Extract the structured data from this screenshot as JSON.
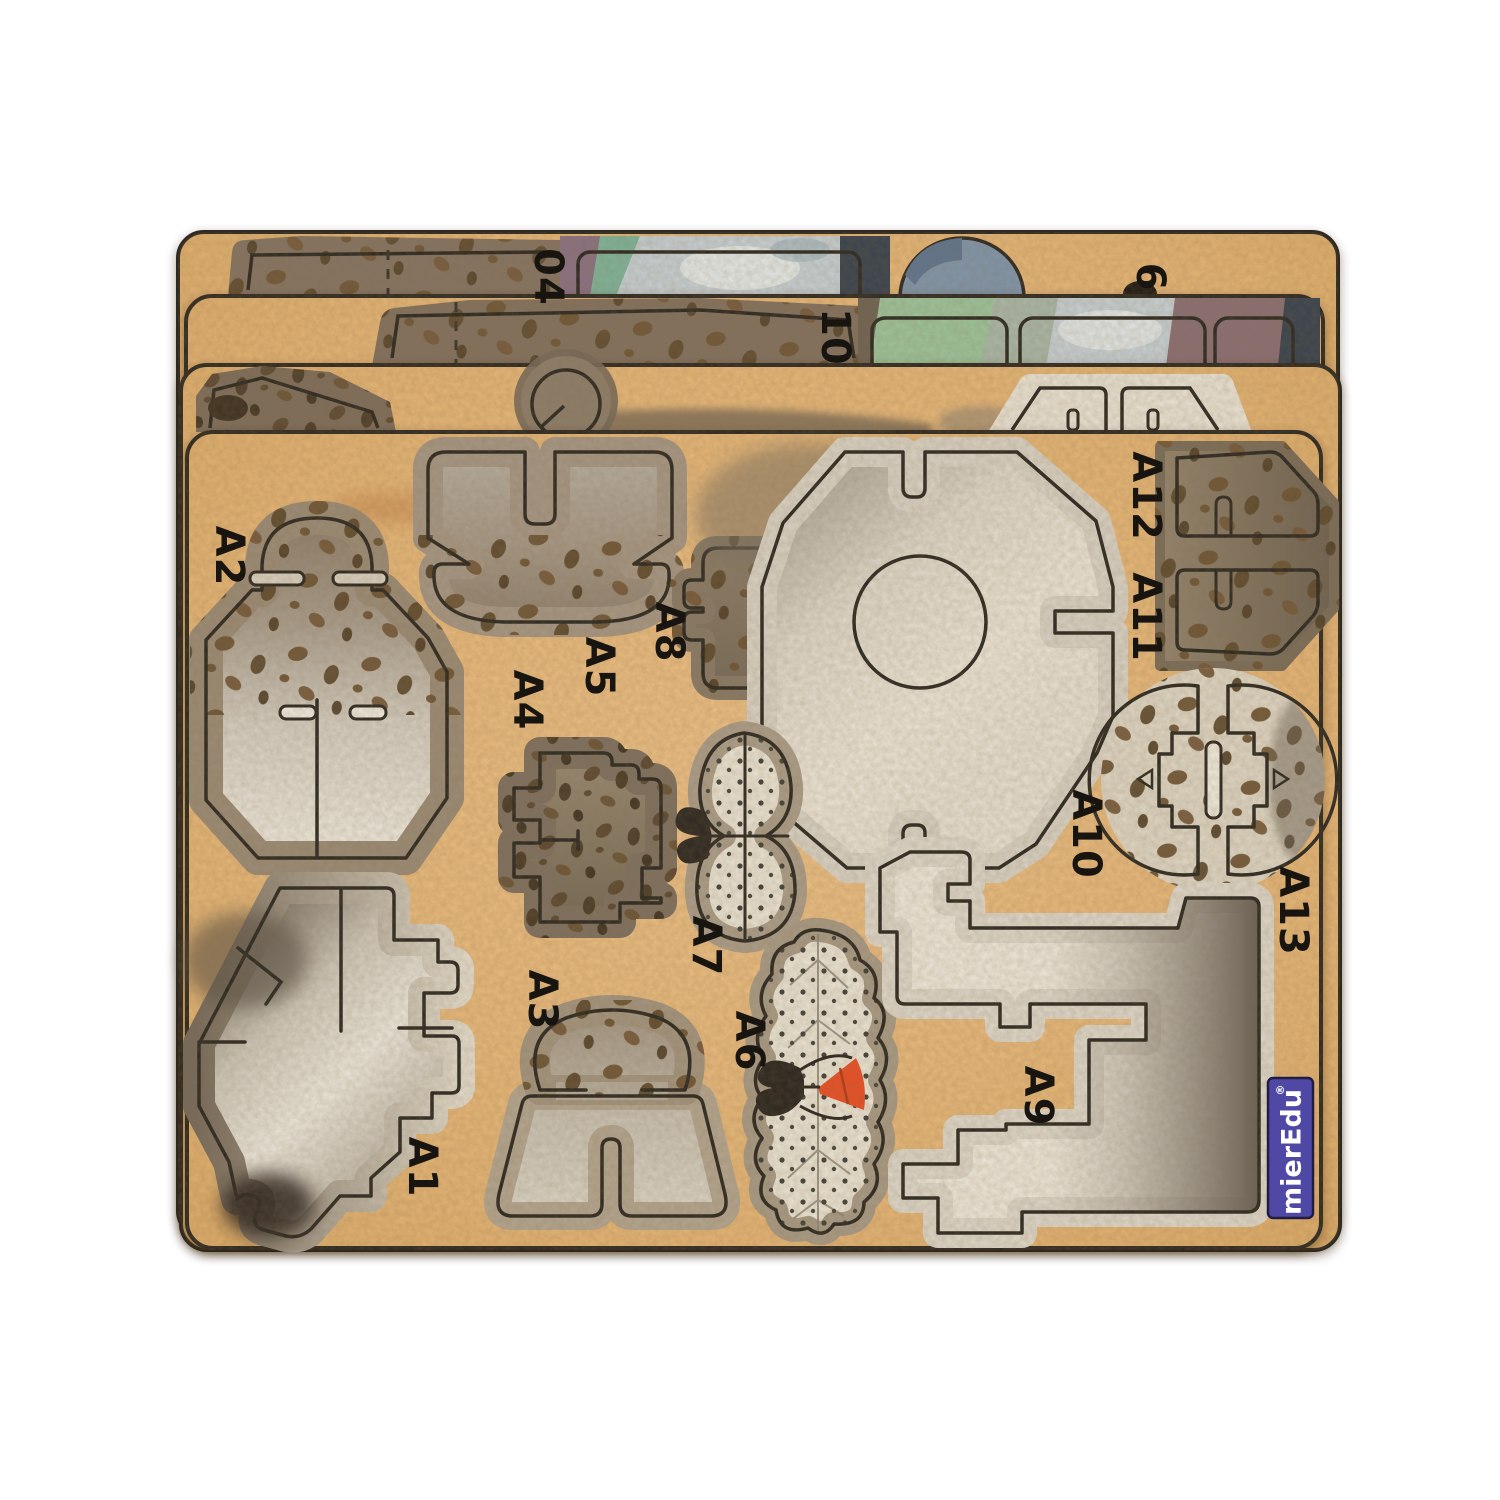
{
  "product": {
    "type": "die-cut cardboard 3D puzzle sheets",
    "sheet_count": 4
  },
  "brand": {
    "logo_text": "mierEdu",
    "registered_mark": "®"
  },
  "front_sheet_piece_labels": {
    "a1": "A1",
    "a2": "A2",
    "a3": "A3",
    "a4": "A4",
    "a5": "A5",
    "a6": "A6",
    "a7": "A7",
    "a8": "A8",
    "a9": "A9",
    "a10": "A10",
    "a11": "A11",
    "a12": "A12",
    "a13": "A13"
  },
  "back_sheet_labels": {
    "sheet1_number": "04",
    "sheet1_right_number": "6",
    "sheet2_number": "10"
  },
  "colors": {
    "background": "#ffffff",
    "kraft": "#e3b273",
    "kraft_light": "#ecc187",
    "outline": "#2d2922",
    "cream": "#e9e2d4",
    "halo_light": "#d8d1c4",
    "halo_brown": "#96866f",
    "speckle_spot": "#6d5434",
    "logo_bg": "#4f49a5",
    "logo_text": "#ffffff",
    "accent_orange": "#e94f26",
    "piece_green": "#9cc39b",
    "piece_marble": "#c6cfd3",
    "piece_mauve": "#8b6f74",
    "piece_navy": "#39434f",
    "piece_bluegrey": "#8095ab",
    "piece_teal": "#7fb39a",
    "piece_plum": "#8b7183"
  }
}
